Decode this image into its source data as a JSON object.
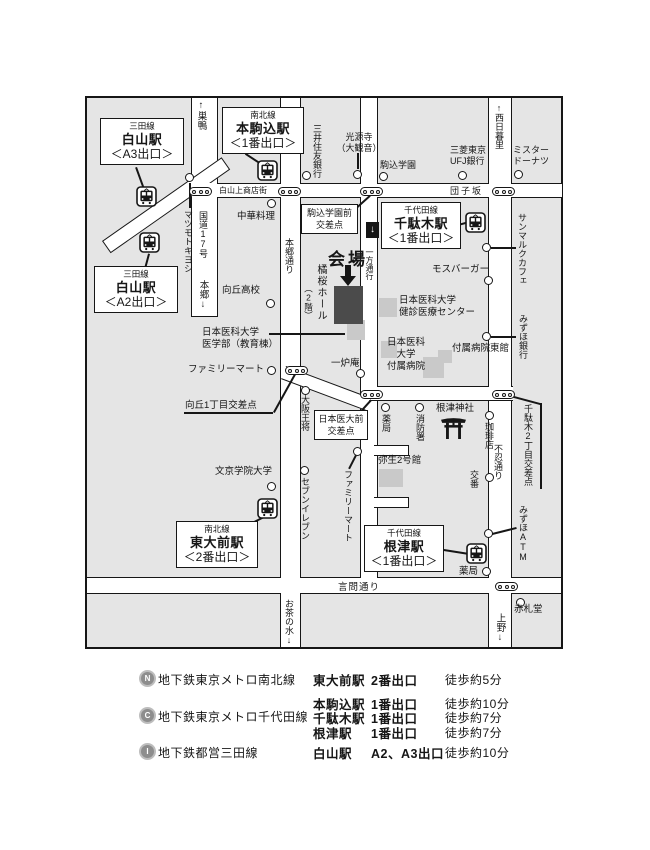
{
  "colors": {
    "block_gray": "#e5e5e5",
    "building_gray": "#c9c9c9",
    "venue_dark": "#4b4b4b",
    "line_black": "#161616"
  },
  "m": {
    "venue": {
      "kaijo": "会場",
      "hall": "橘桜ホール",
      "floor": "（2階）"
    },
    "st": {
      "a3": {
        "line": "三田線",
        "name": "白山駅",
        "exit": "＜A3出口＞"
      },
      "honkoma": {
        "line": "南北線",
        "name": "本駒込駅",
        "exit": "＜1番出口＞"
      },
      "a2": {
        "line": "三田線",
        "name": "白山駅",
        "exit": "＜A2出口＞"
      },
      "sendagi": {
        "line": "千代田線",
        "name": "千駄木駅",
        "exit": "＜1番出口＞"
      },
      "todaimae": {
        "line": "南北線",
        "name": "東大前駅",
        "exit": "＜2番出口＞"
      },
      "nezu": {
        "line": "千代田線",
        "name": "根津駅",
        "exit": "＜1番出口＞"
      }
    },
    "roads": {
      "shotengai": "白山上商店街",
      "dangozaka": "団子坂",
      "kototoi": "言問通り",
      "r17": "国道17号",
      "sugamo": "↑巣鴨",
      "hongo_arrow": "本郷↓",
      "hongodori": "本郷通り",
      "nishinippori": "↑西日暮里",
      "shinobazu": "不忍通り",
      "ochanomizu": "お茶の水↓",
      "ueno": "上野↓",
      "ichiho": "一方通行",
      "oneway_arrow": "↓"
    },
    "ix": {
      "komagome1": "駒込学園前",
      "komagome2": "交差点",
      "mukogaoka": "向丘1丁目交差点",
      "idaimae1": "日本医大前",
      "idaimae2": "交差点",
      "sendagi2": "千駄木2丁目交差点"
    },
    "poi": {
      "chuka": "中華料理",
      "matsukiyo": "マツモトキヨシ",
      "mitsui": "三井住友銀行",
      "kogenji1": "光源寺",
      "kogenji2": "（大観音）",
      "komagome_gakuen": "駒込学園",
      "mufg1": "三菱東京",
      "mufg2": "UFJ銀行",
      "donut1": "ミスター",
      "donut2": "ドーナツ",
      "mos": "モスバーガー",
      "saintmarc": "サンマルクカフェ",
      "mizuho_bank": "みずほ銀行",
      "mukogaoka_hs": "向丘高校",
      "med1": "日本医科大学",
      "med2": "医学部（教育棟）",
      "famima1": "ファミリーマート",
      "ichiroan": "一炉庵",
      "kenshin1": "日本医科大学",
      "kenshin2": "健診医療センター",
      "fuzoku1": "日本医科",
      "fuzoku2": "大学",
      "fuzoku3": "付属病院",
      "tokan": "付属病院東館",
      "osho": "大阪王将",
      "seven": "セブンイレブン",
      "famima2": "ファミリーマート",
      "bunkyo": "文京学院大学",
      "yakkyoku1": "薬局",
      "shobo": "消防署",
      "nezujinja": "根津神社",
      "coffee": "珈琲店",
      "koban": "交番",
      "yayoi": "弥生2号館",
      "mizuho_atm": "みずほATM",
      "yakkyoku2": "薬局",
      "akafudado": "赤札堂"
    }
  },
  "legend": {
    "lines": [
      {
        "icon": "N",
        "name": "地下鉄東京メトロ南北線"
      },
      {
        "icon": "C",
        "name": "地下鉄東京メトロ千代田線"
      },
      {
        "icon": "I",
        "name": "地下鉄都営三田線"
      }
    ],
    "entries": [
      {
        "station": "東大前駅",
        "exit": "2番出口",
        "walk": "徒歩約5分"
      },
      {
        "station": "本駒込駅",
        "exit": "1番出口",
        "walk": "徒歩約10分"
      },
      {
        "station": "千駄木駅",
        "exit": "1番出口",
        "walk": "徒歩約7分"
      },
      {
        "station": "根津駅",
        "exit": "1番出口",
        "walk": "徒歩約7分"
      },
      {
        "station": "白山駅",
        "exit": "A2、A3出口",
        "walk": "徒歩約10分"
      }
    ]
  }
}
